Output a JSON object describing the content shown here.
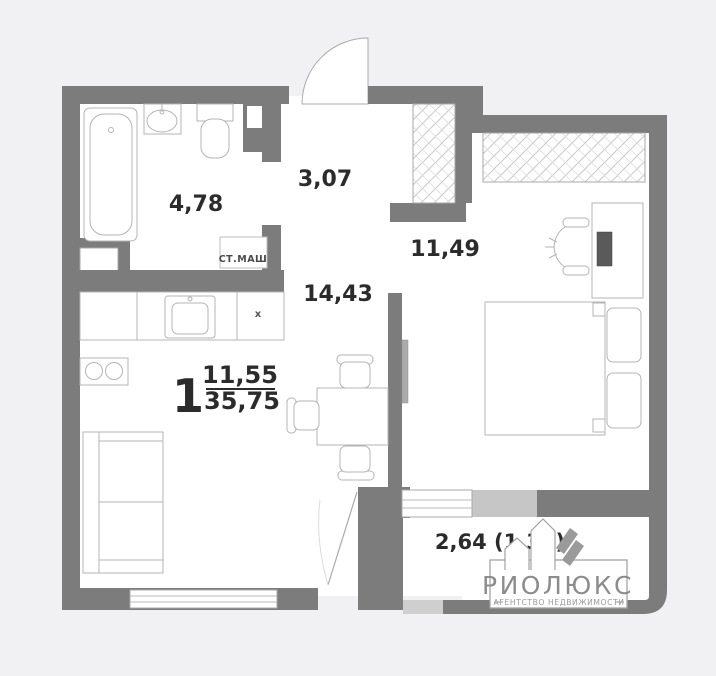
{
  "plan": {
    "type": "apartment-floor-plan",
    "rooms": [
      {
        "id": "bathroom",
        "area": "4,78"
      },
      {
        "id": "hallway",
        "area": "3,07"
      },
      {
        "id": "bedroom",
        "area": "11,49"
      },
      {
        "id": "living-kitchen",
        "area": "14,43"
      },
      {
        "id": "balcony",
        "area": "2,64 (1,32)"
      }
    ],
    "summary": {
      "rooms_count": "1",
      "living_area": "11,55",
      "total_area": "35,75"
    },
    "annotations": {
      "washing_machine": "СТ.МАШ",
      "vent_mark": "x"
    }
  },
  "logo": {
    "name": "РИОЛЮКС",
    "tagline": "АГЕНТСТВО НЕДВИЖИМОСТИ"
  },
  "colors": {
    "background": "#f1f1f4",
    "floor": "#ffffff",
    "wall": "#7c7c7c",
    "wall_light": "#c6c6c6",
    "furniture_line": "#b4b4b4",
    "label_text": "#2b2b2b",
    "logo_gray": "#8c8c8c"
  }
}
